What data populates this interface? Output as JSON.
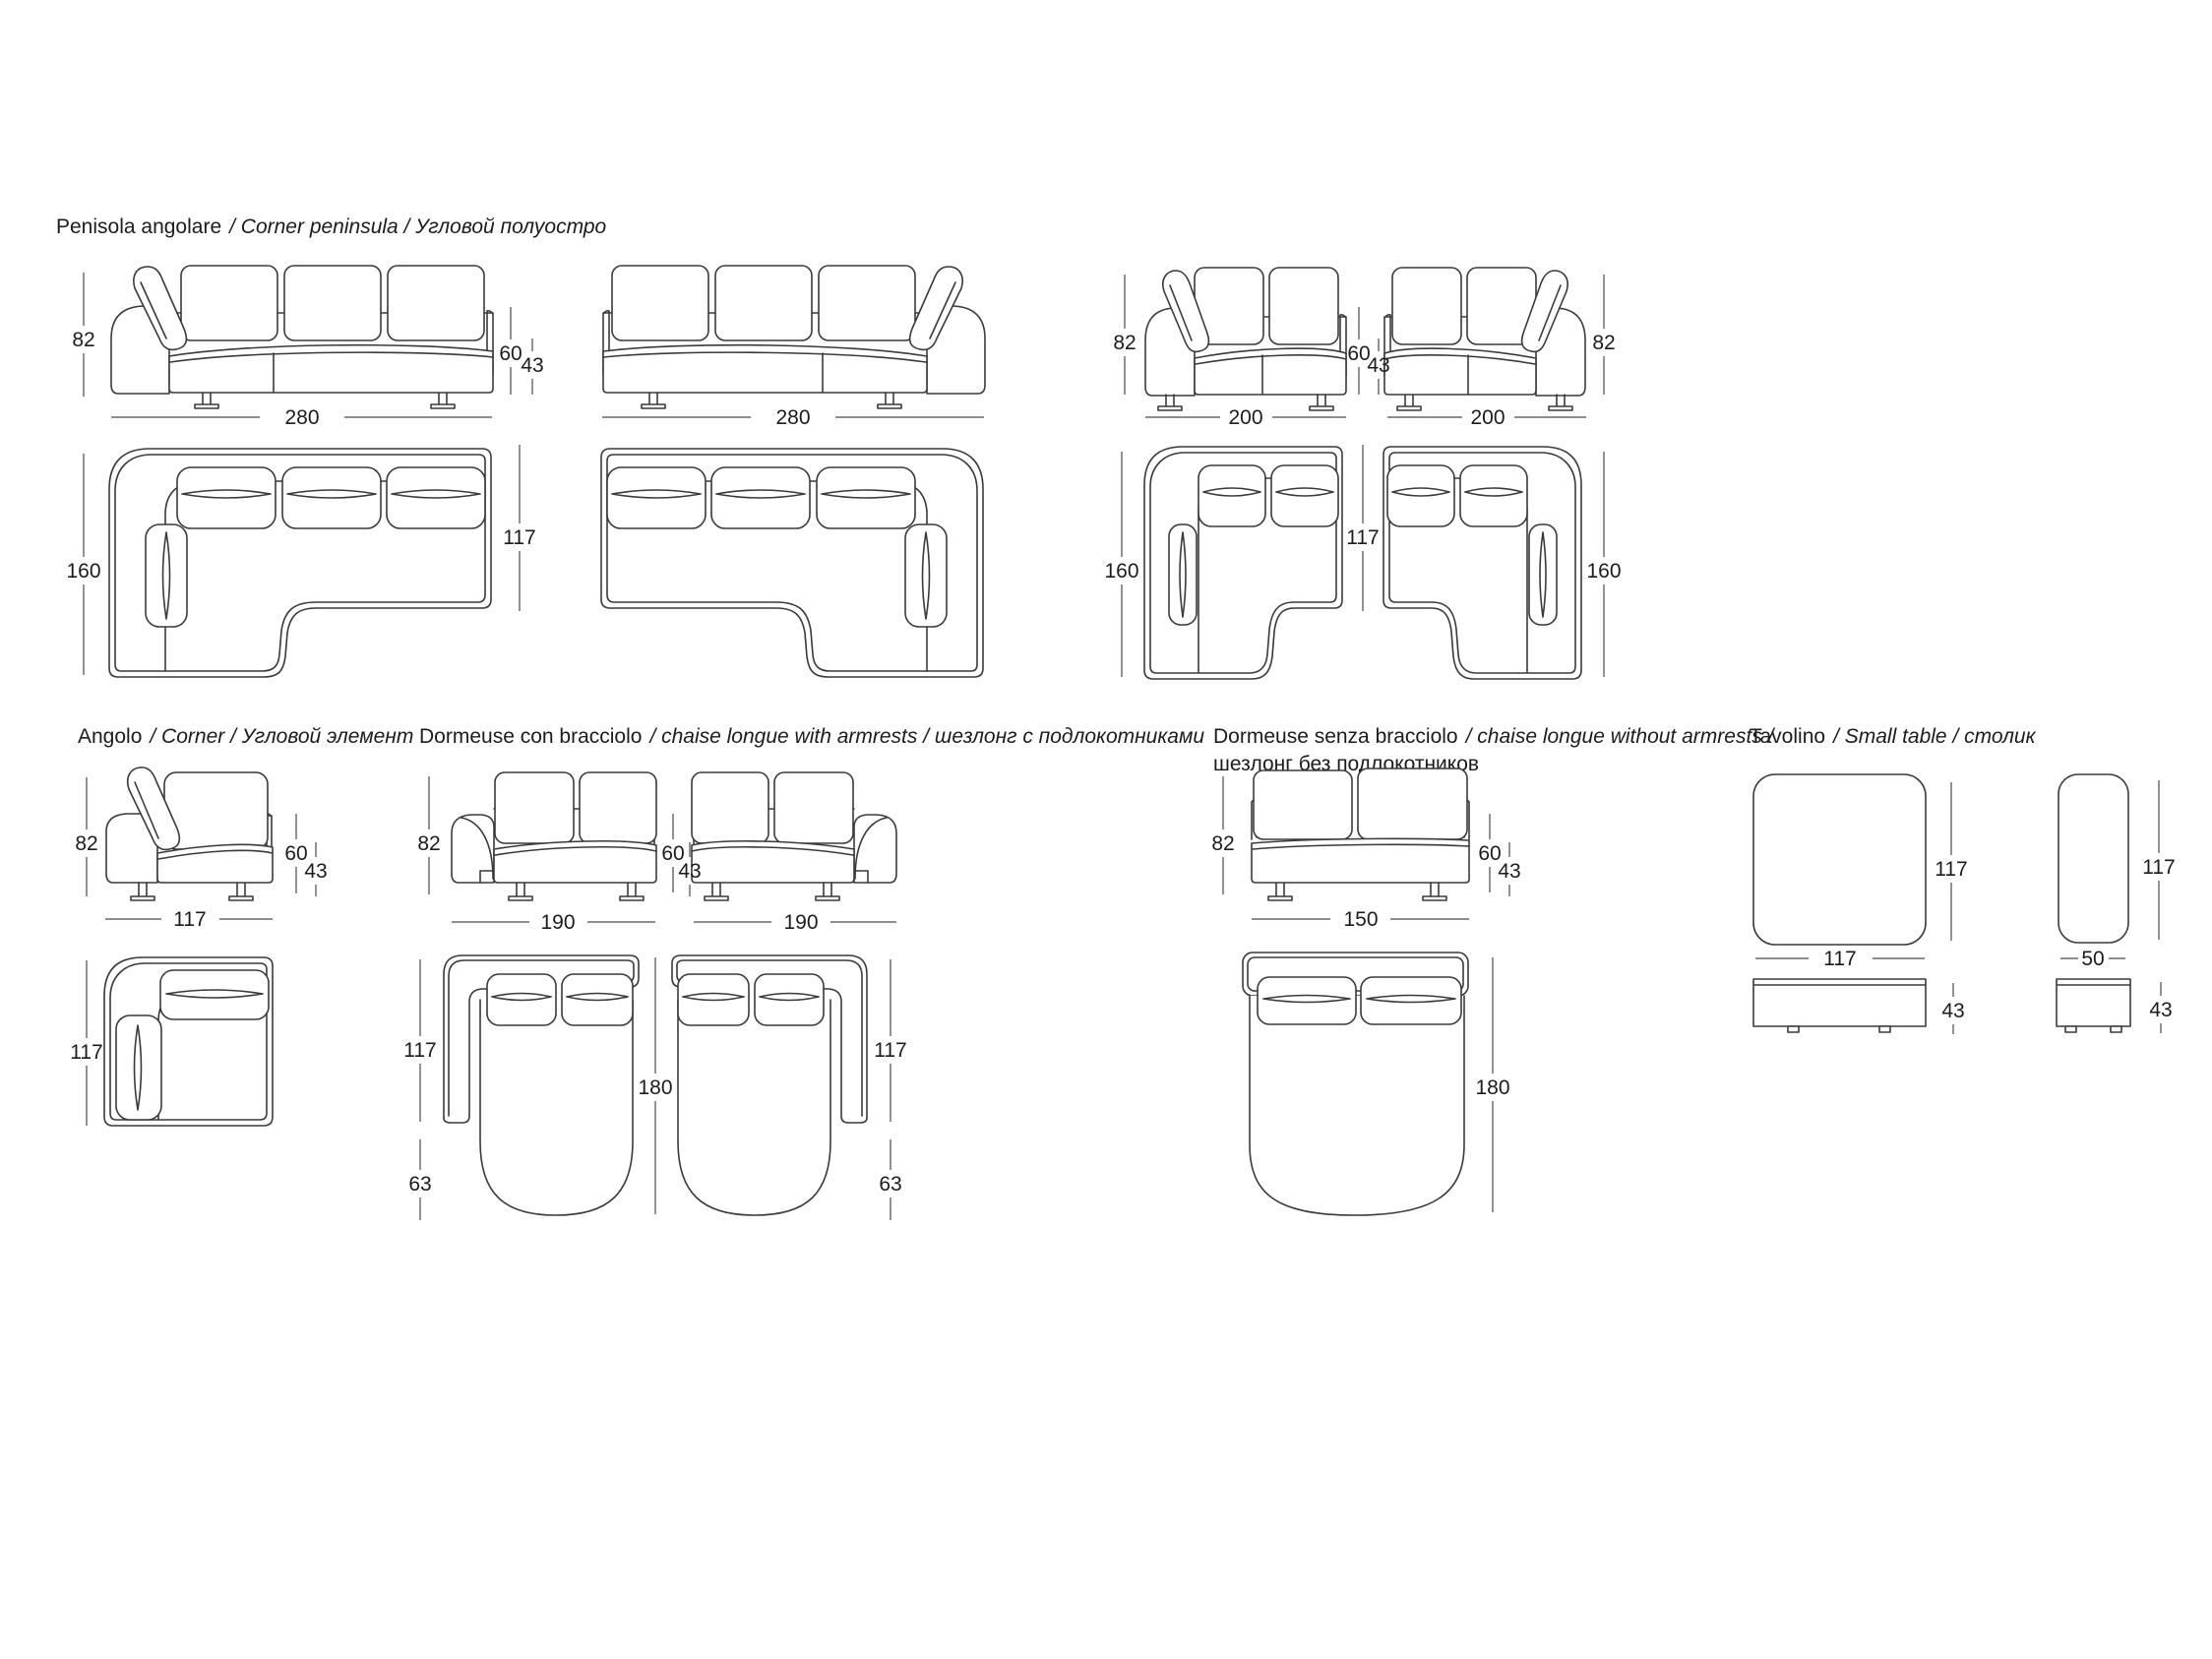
{
  "canvas": {
    "background": "#ffffff",
    "line_color": "#3a3a3a",
    "text_color": "#1c1c1c"
  },
  "sections": {
    "peninsula": {
      "name": "Penisola angolare",
      "name_alt": "/ Corner  peninsula / Угловой полуостро"
    },
    "corner": {
      "name": "Angolo",
      "name_alt": "/ Corner / Угловой элемент"
    },
    "dormeuse_armrests": {
      "name": "Dormeuse con bracciolo",
      "name_alt": "/ chaise longue with armrests / шезлонг с подлокотниками"
    },
    "dormeuse_no_armrests": {
      "name": "Dormeuse senza bracciolo",
      "name_alt": "/ chaise longue without armrests /",
      "name_alt2": "шезлонг без подлокотников"
    },
    "small_table": {
      "name": "Tavolino",
      "name_alt": "/ Small table / столик"
    }
  },
  "dimensions": {
    "height_total": "82",
    "height_backrest": "60",
    "height_seat": "43",
    "width_280": "280",
    "width_200": "200",
    "width_190": "190",
    "width_150": "150",
    "width_117": "117",
    "width_50": "50",
    "depth_160": "160",
    "depth_117": "117",
    "depth_180": "180",
    "depth_63": "63"
  }
}
